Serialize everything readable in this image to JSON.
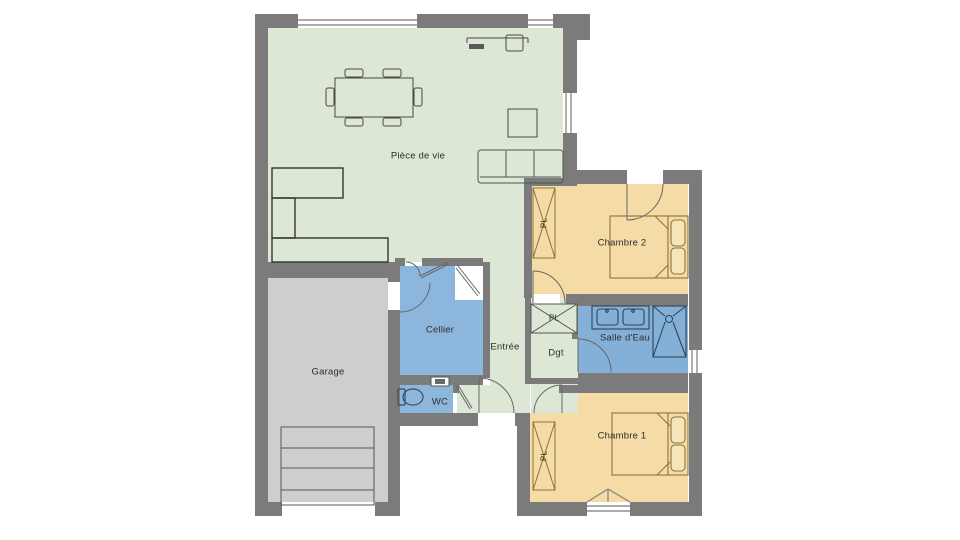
{
  "plan": {
    "rooms": {
      "living_room": {
        "label": "Pièce de vie"
      },
      "bedroom_2": {
        "label": "Chambre 2"
      },
      "bedroom_1": {
        "label": "Chambre 1"
      },
      "pantry": {
        "label": "Cellier"
      },
      "entry": {
        "label": "Entrée"
      },
      "hallway": {
        "label": "Dgt"
      },
      "bathroom": {
        "label": "Salle d'Eau"
      },
      "toilet": {
        "label": "WC"
      },
      "garage": {
        "label": "Garage"
      },
      "closet": {
        "label": "PL"
      }
    },
    "colors": {
      "wall": "#7b7b7b",
      "living": "#dce7d6",
      "bedroom": "#f5dba6",
      "pantry": "#8db6dc",
      "bathroom": "#84b0d8",
      "garage": "#cccfcb",
      "background": "#ffffff"
    }
  }
}
